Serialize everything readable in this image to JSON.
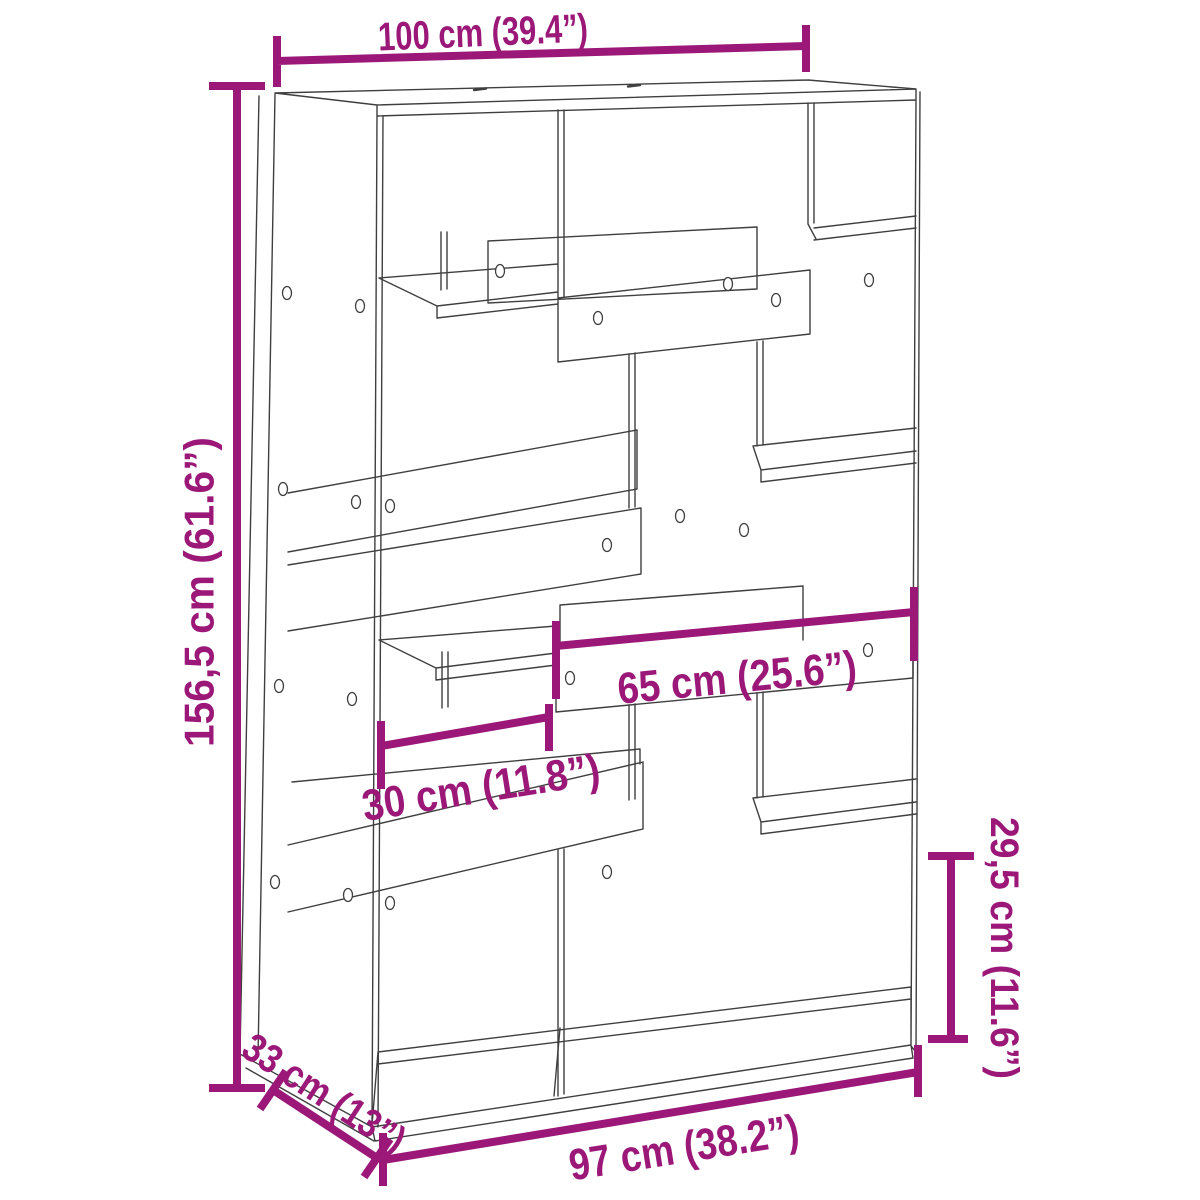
{
  "colors": {
    "dimension_accent": "#9B1878",
    "drawing_line": "#3F3F3F",
    "background": "#FFFFFF"
  },
  "dimensions": {
    "top_width": {
      "label": "100 cm (39.4”)"
    },
    "left_height": {
      "label": "156,5 cm (61.6”)"
    },
    "middle_shelf_width": {
      "label": "65 cm (25.6”)"
    },
    "left_compartment_width": {
      "label": "30 cm (11.8”)"
    },
    "right_compartment_height": {
      "label": "29,5 cm (11.6”)"
    },
    "bottom_depth": {
      "label": "33 cm (13”)"
    },
    "bottom_width": {
      "label": "97 cm (38.2”)"
    }
  }
}
